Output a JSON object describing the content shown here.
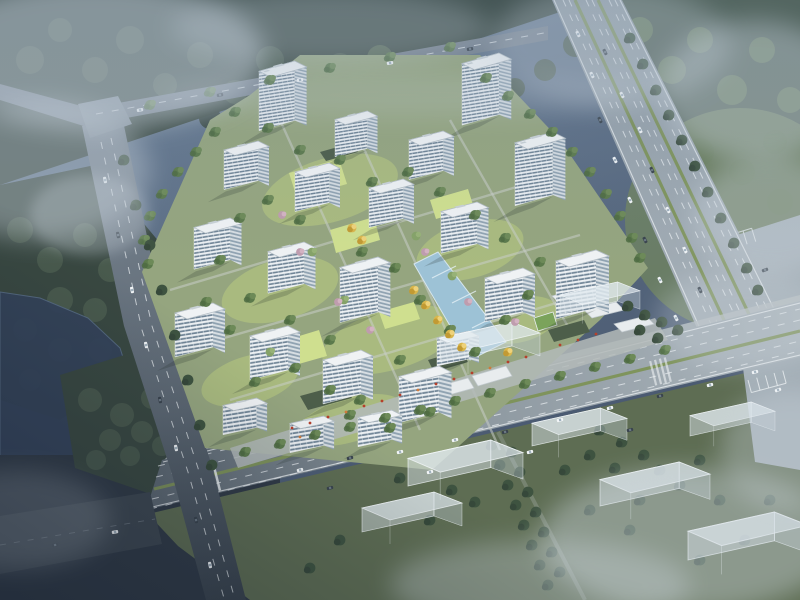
{
  "scene": {
    "kind": "aerial-architectural-rendering",
    "subject": "residential-complex-masterplan-birdseye",
    "text_content": "none"
  },
  "palette": {
    "bg_top": "#70849a",
    "bg_low": "#44536a",
    "fog_white": "#ccd6de",
    "forest_dark": "#394841",
    "forest_mid": "#4b5c4f",
    "forest_bright": "#667a58",
    "forest_moss": "#72855f",
    "tree_green": "#5c7a4c",
    "tree_dark": "#3e5340",
    "tree_lite": "#85a268",
    "tree_gold": "#d9b64c",
    "tree_pink": "#bf9cae",
    "water_lake": "#34435a",
    "canal_blue": "#9dc2d6",
    "road_surface": "#9aa5ae",
    "road_dark": "#39434f",
    "road_line": "#edf1f4",
    "median_green": "#7d9257",
    "parking": "#a3aeb6",
    "site_ground": "#95a57f",
    "lawn_mid": "#aec07f",
    "lawn_bright": "#cfdf8f",
    "path_light": "#c8cec9",
    "bldg_face": "#ebeff2",
    "bldg_window": "#6f8496",
    "bldg_side": "#d7dee3",
    "bldg_side_win": "#8fa2b1",
    "roof_white": "#eff2f4",
    "roof_edge": "#b4bec5",
    "podium_green": "#4d5e4a",
    "ghost_fill": "rgba(216,226,232,0.5)",
    "ghost_side": "rgba(196,208,216,0.4)",
    "ghost_edge": "rgba(246,250,252,0.75)",
    "shadow_dark": "rgba(35,48,42,0.45)",
    "car_white": "#f3f6f8",
    "car_dark": "#39434d",
    "accent_red": "#b5402c",
    "accent_orange": "#cf7a3c"
  }
}
